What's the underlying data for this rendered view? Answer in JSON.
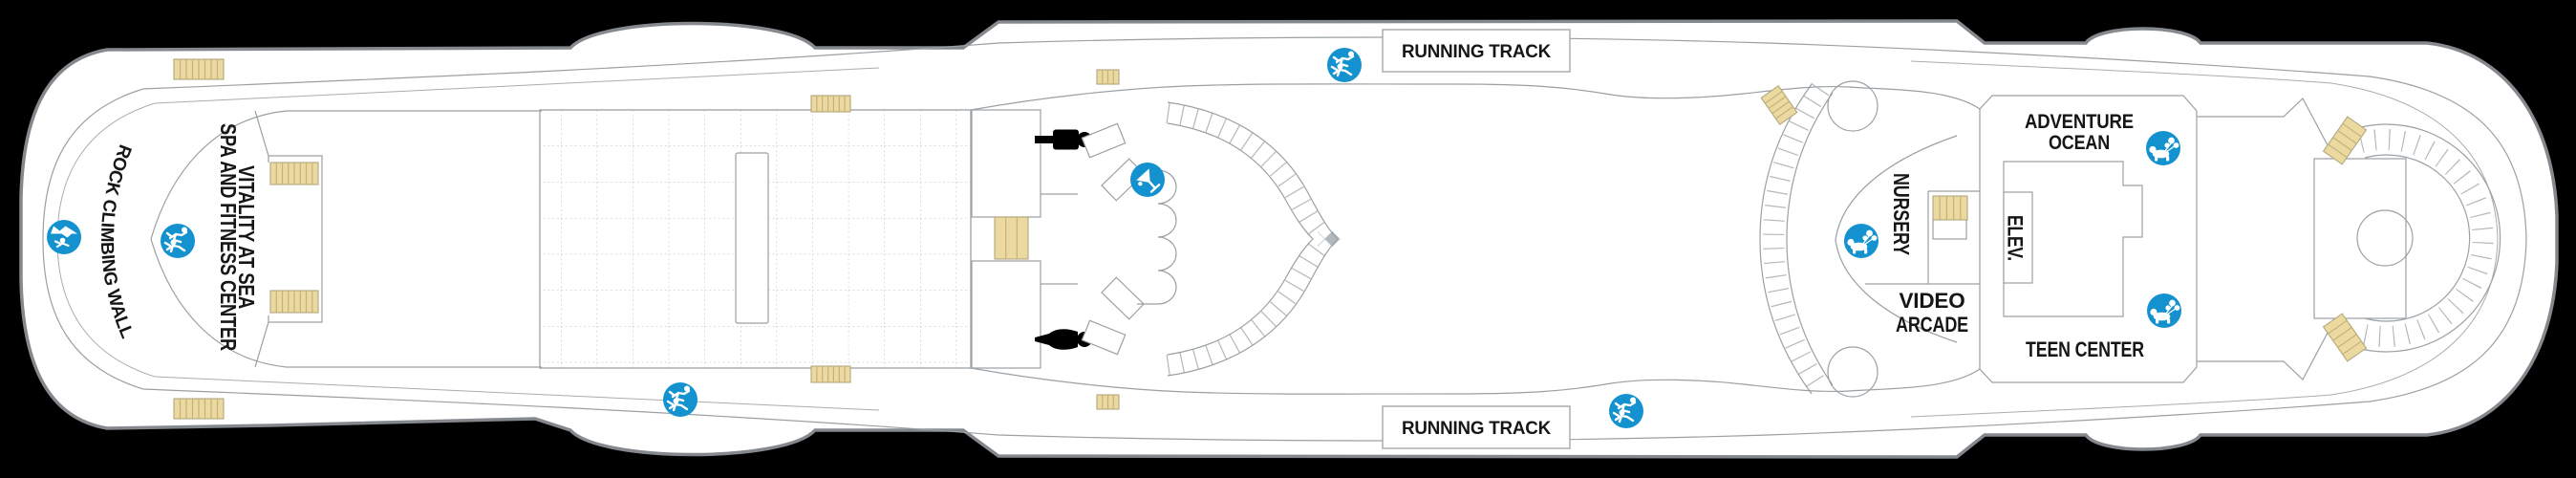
{
  "deck_plan": {
    "type": "cruise-ship-deck-plan",
    "colors": {
      "background": "#000000",
      "hull": "#ffffff",
      "outline_gray": "#85898d",
      "detail_line_gray": "#9aa0a4",
      "accent_blue": "#1492cf",
      "stair_tan": "#ecd9a0",
      "text": "#161616"
    },
    "labels": {
      "running_track_top": "RUNNING TRACK",
      "running_track_bottom": "RUNNING TRACK",
      "rock_climbing_wall": "ROCK CLIMBING WALL",
      "spa_line1": "VITALITY AT SEA",
      "spa_line2": "SPA AND FITNESS CENTER",
      "nursery": "NURSERY",
      "adventure_ocean_line1": "ADVENTURE",
      "adventure_ocean_line2": "OCEAN",
      "elevator": "ELEV.",
      "video_arcade_line1": "VIDEO",
      "video_arcade_line2": "ARCADE",
      "teen_center": "TEEN CENTER"
    },
    "icons": {
      "rock_climbing": "climbing-wall-icon",
      "spa_fitness": "running-figures-icon",
      "running_track_top": "running-figures-icon",
      "running_track_bottom_left": "running-figures-icon",
      "running_track_bottom_right": "running-figures-icon",
      "bar": "martini-glass-icon",
      "nursery": "children-playing-icon",
      "adventure_ocean": "children-playing-icon",
      "teen_center": "children-playing-icon",
      "mens_locker": "male-figure-icon",
      "womens_locker": "female-figure-icon"
    }
  }
}
